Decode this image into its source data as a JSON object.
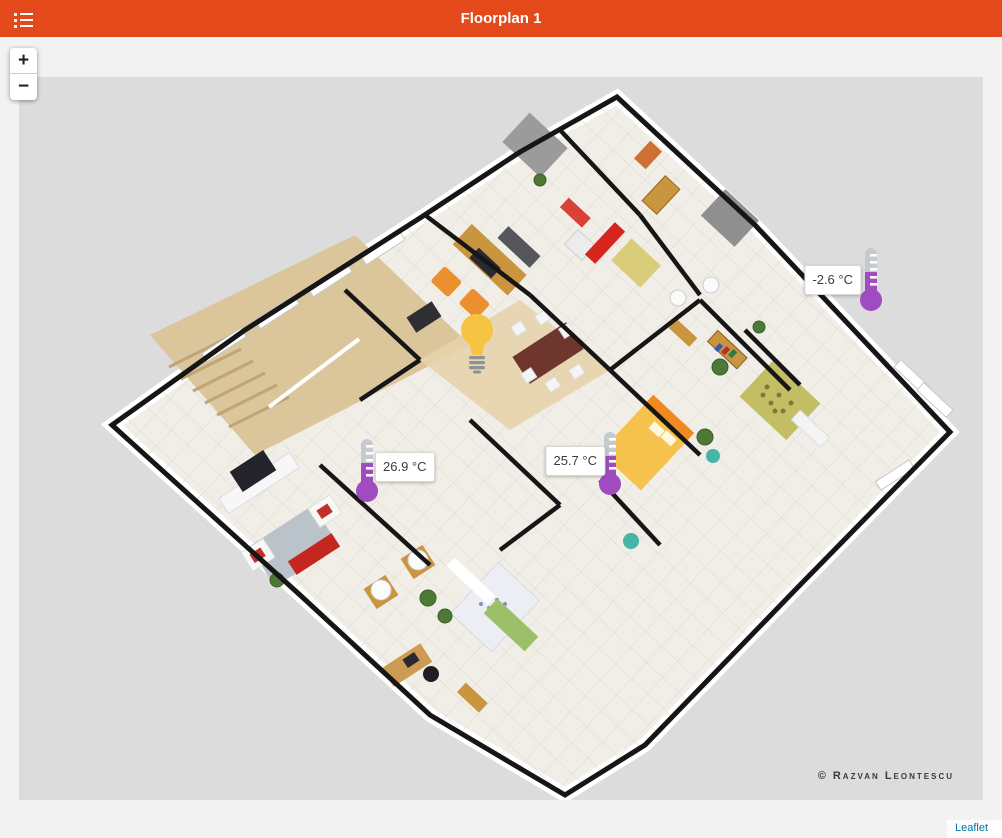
{
  "header": {
    "title": "Floorplan 1"
  },
  "zoom_control": {
    "zoom_in": "+",
    "zoom_out": "−"
  },
  "sensors": {
    "temperatures": [
      {
        "id": "thermometer-1",
        "value": "-2.6 °C",
        "label_side": "left"
      },
      {
        "id": "thermometer-2",
        "value": "26.9 °C",
        "label_side": "right"
      },
      {
        "id": "thermometer-3",
        "value": "25.7 °C",
        "label_side": "left"
      }
    ],
    "light": {
      "id": "light-1",
      "icon": "lightbulb"
    }
  },
  "floorplan": {
    "credit": "© Razvan Leontescu"
  },
  "attribution": {
    "label": "Leaflet"
  },
  "colors": {
    "header_bg": "#E4491B",
    "image_bg": "#DCDCDC",
    "page_bg": "#F2F2F2",
    "thermometer_purple": "#A04CC0",
    "thermometer_gray": "#C5CACF",
    "bulb_amber": "#F7C343",
    "attribution_link": "#0078A8"
  }
}
